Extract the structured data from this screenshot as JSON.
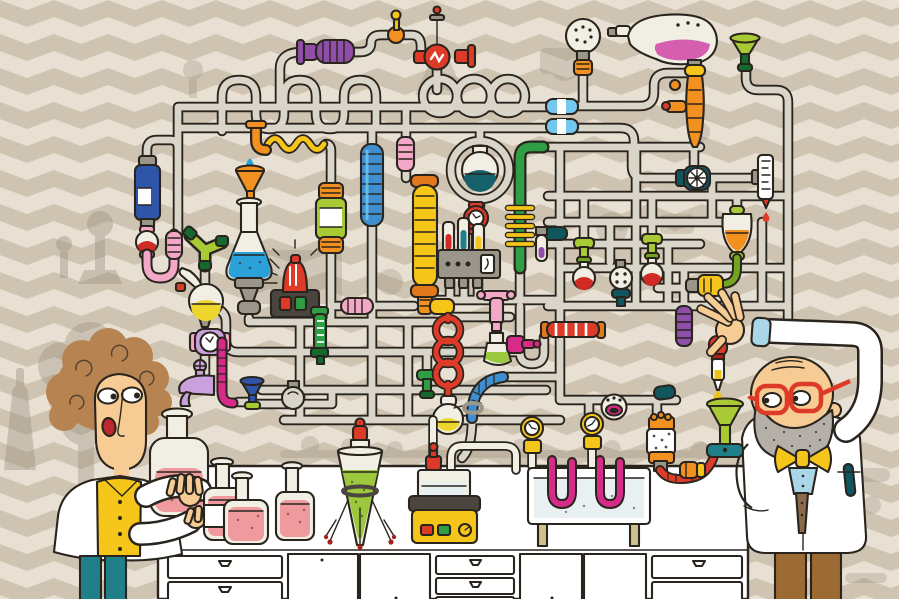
{
  "palette": {
    "ink": "#29241e",
    "pipe": "#d9d5c9",
    "glass": "#f1efe4",
    "wallCream": "#e8e1d3",
    "wallBeige": "#cfc4b1",
    "silhouette": "#95887a",
    "white": "#ffffff",
    "red": "#dd3a28",
    "darkRed": "#a8221a",
    "orange": "#f29120",
    "amber": "#e2791c",
    "yellow": "#f6c51a",
    "lime": "#a8ca35",
    "limeDark": "#73a41f",
    "green": "#2f9e44",
    "greenDark": "#14692e",
    "teal": "#1f808a",
    "tealDark": "#0f565e",
    "navy": "#2f55a8",
    "skyBlue": "#74c8f0",
    "medBlue": "#3e8ed0",
    "liquidBlue": "#2aa1d8",
    "purple": "#8f4fa8",
    "lilac": "#c9a2dd",
    "magenta": "#d62b88",
    "pink": "#f2a8c6",
    "salmon": "#ef9a9c",
    "orchid": "#d55fae",
    "skin": "#f7cb94",
    "hair": "#b78351",
    "mouthRed": "#bf2730",
    "brown": "#9c6a33",
    "tan": "#cfc28d",
    "beard": "#b5b0a7",
    "slate": "#4a453e",
    "steel": "#9b968a",
    "water": "#e9f0f2",
    "vestBlue": "#a9d6e8",
    "tieBrown": "#8a6a4a",
    "dropYellow": "#ecc419",
    "liquidYellow": "#eed62c",
    "liquidGreen": "#9cc83e",
    "liquidRed": "#cf2b24",
    "liquidTeal": "#16606b"
  },
  "scene": {
    "setting": "cartoon chemistry laboratory with a wall-sized maze of grey pipes and colorful glassware",
    "wallpaper": {
      "pattern": "chevron",
      "colors": [
        "wallCream",
        "wallBeige"
      ]
    },
    "characters": [
      {
        "id": "woman-scientist",
        "side": "left",
        "hair": "curly light-brown",
        "expression": "surprised",
        "outfit": {
          "coat": "white lab coat",
          "shirt": "yellow with buttons",
          "pants": "teal"
        },
        "action": "holding a glass jar of pink liquid under a dripping faucet"
      },
      {
        "id": "man-scientist",
        "side": "right",
        "features": "bald with grey stubbly beard and round red glasses",
        "outfit": {
          "coat": "white lab coat",
          "bowtie": "yellow",
          "vest": "light blue",
          "pants": "brown",
          "pocket": "teal pen"
        },
        "action": "reaching up to squeeze a dropper into a green funnel"
      }
    ],
    "equipment": [
      "purple-coil-coupling",
      "brass-key-valve",
      "red-dial-valve",
      "sprinkler-bulb",
      "retort-with-pink-liquid",
      "lime-funnel",
      "orange-column",
      "blue-hose-couplings",
      "pipe-loops",
      "serpentine-pipes",
      "blue-reagent-bottle",
      "pink-u-tube",
      "green-y-junction",
      "orange-funnel",
      "flask-of-blue-liquid",
      "yellow-wave-tube",
      "green-canister",
      "blue-ribbed-column",
      "yellow-ribbed-column",
      "glass-bulb-with-teal-liquid",
      "red-clock-gauge",
      "test-tube-manifold",
      "green-column-with-yellow-coil",
      "purple-test-tube",
      "red-spiral-tube",
      "flask-of-yellow-liquid",
      "pink-tap",
      "flask-of-green-liquid",
      "magenta-pump",
      "red-striped-coupling",
      "lime-valve-flasks",
      "perforated-connector",
      "teal-valve",
      "wheel-valve",
      "burette",
      "separatory-funnel-orange",
      "yellow-bracket-coupling",
      "alarm-beacon",
      "lilac-clock-gauge",
      "lilac-faucet",
      "retort-with-yellow-liquid",
      "green-graduated-valve",
      "blue-funnel",
      "ball-valve",
      "pink-ribbed-coupling",
      "blue-ribbed-elbow",
      "dotted-sphere-valve",
      "teal-coupling",
      "purple-ribbed-coupling",
      "filter-canister",
      "red-segmented-hose",
      "pipette-dropper",
      "green-funnel",
      "water-bath-with-u-tubes",
      "yellow-clock-gauges",
      "hot-plate",
      "beaker-on-hot-plate",
      "cone-flask-on-tripod",
      "jars-of-pink-liquid",
      "glass-jug-of-pink-liquid",
      "drip-faucet",
      "lab-bench-with-drawers"
    ],
    "furniture": {
      "bench": {
        "color": "white",
        "drawers": 7,
        "doors": 4
      }
    }
  }
}
